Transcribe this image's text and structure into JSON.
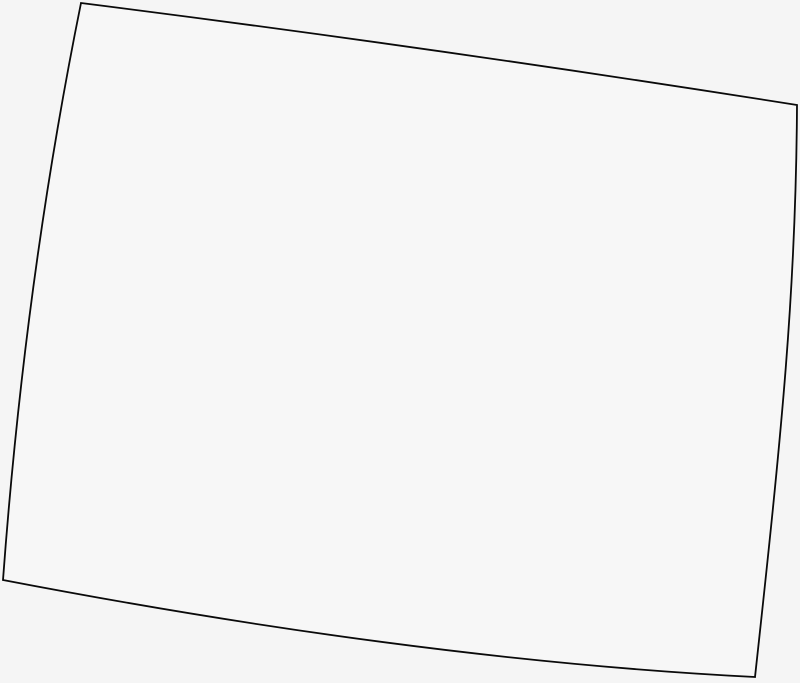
{
  "map": {
    "region": "Wyoming",
    "description": "Blank outline map of the state of Wyoming (no labels, no other UI elements)",
    "outline_path": "M 81,3 Q 430,47 797,105 C 796,290 782,430 755,677 Q 420,660 3,580 Q 25,280 81,3 Z",
    "corners": {
      "top_left": [
        81,
        3
      ],
      "top_right": [
        797,
        105
      ],
      "bottom_right": [
        755,
        677
      ],
      "bottom_left": [
        3,
        580
      ]
    },
    "colors": {
      "background": "#f5f5f5",
      "fill": "#f7f7f7",
      "stroke": "#0a0a0a"
    },
    "stroke_width": "1.8",
    "canvas": {
      "width": 800,
      "height": 683
    }
  }
}
